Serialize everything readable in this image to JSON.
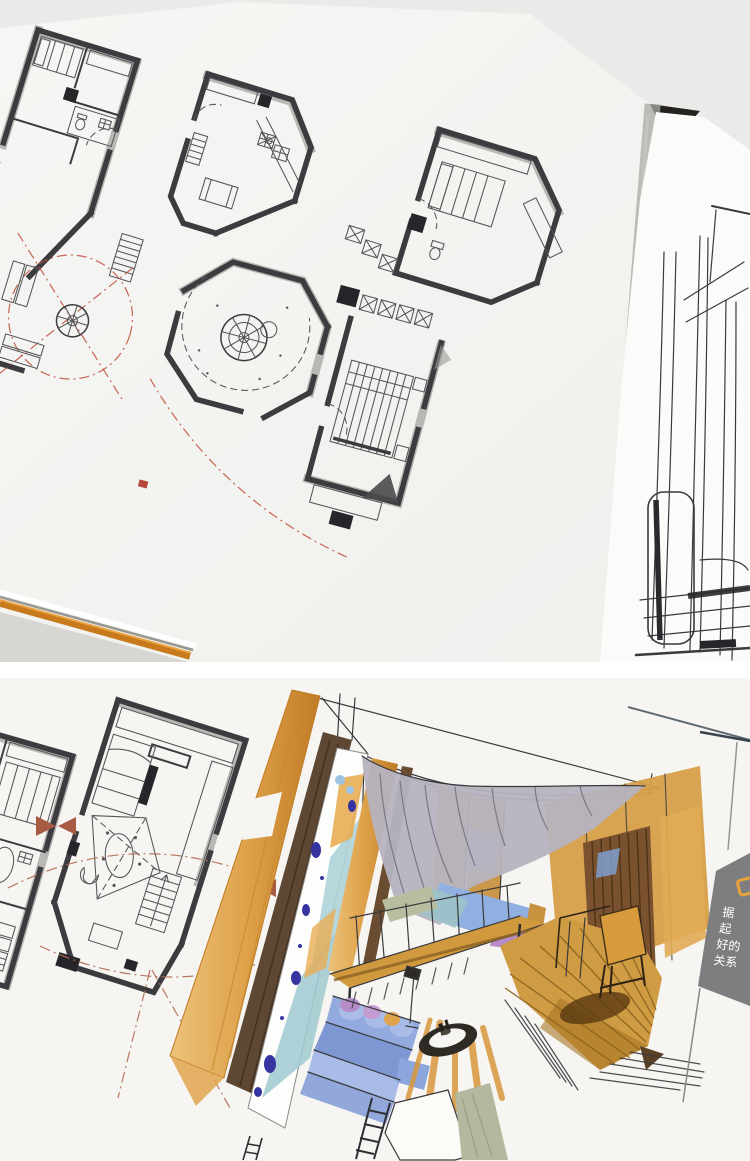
{
  "photos": {
    "top": {
      "alt": "open book spread: hand-drawn ink floor plans with gray marker walls and red dash-dot guide circles"
    },
    "bottom": {
      "alt": "book page: small-apartment floor plans beside a marker and watercolor interior perspective sketch"
    }
  },
  "caption_panel": {
    "background": "#7e7e81",
    "icon": "rounded-square-outline-icon",
    "icon_color": "#e8a33d",
    "text_color": "#ffffff",
    "lines": [
      "据",
      "起",
      "好的",
      "关系"
    ]
  },
  "palette": {
    "paper_top": "#f3f3f1",
    "paper_bottom": "#f6f5f2",
    "backdrop_gray": "#eaeae8",
    "spine_gap_dark": "#24211e",
    "table_gray": "#d7d6d3",
    "cover_orange": "#c8791c",
    "wall_ink": "#3c3c40",
    "red_accent": "#c14b38",
    "red_brown": "#b06a50",
    "column_orange": "#dfa24b",
    "column_orange_deep": "#c07c26",
    "wood_brown": "#5f4833",
    "mural_teal": "#aed3d8",
    "mural_blue": "#3634a0",
    "curtain_gray": "#b6b3bf",
    "loft_orange": "#d0993d",
    "floor_tan": "#cf9b43",
    "floor_shadow": "#5a3a12",
    "sofa_blue": "#8ca6dd",
    "sofa_blue_light": "#a9bce8",
    "cushion_purple": "#b58cc8",
    "rug_sage": "#b4b89e",
    "chair_orange": "#d79b3c",
    "slat_wall_brown": "#7a5230"
  }
}
